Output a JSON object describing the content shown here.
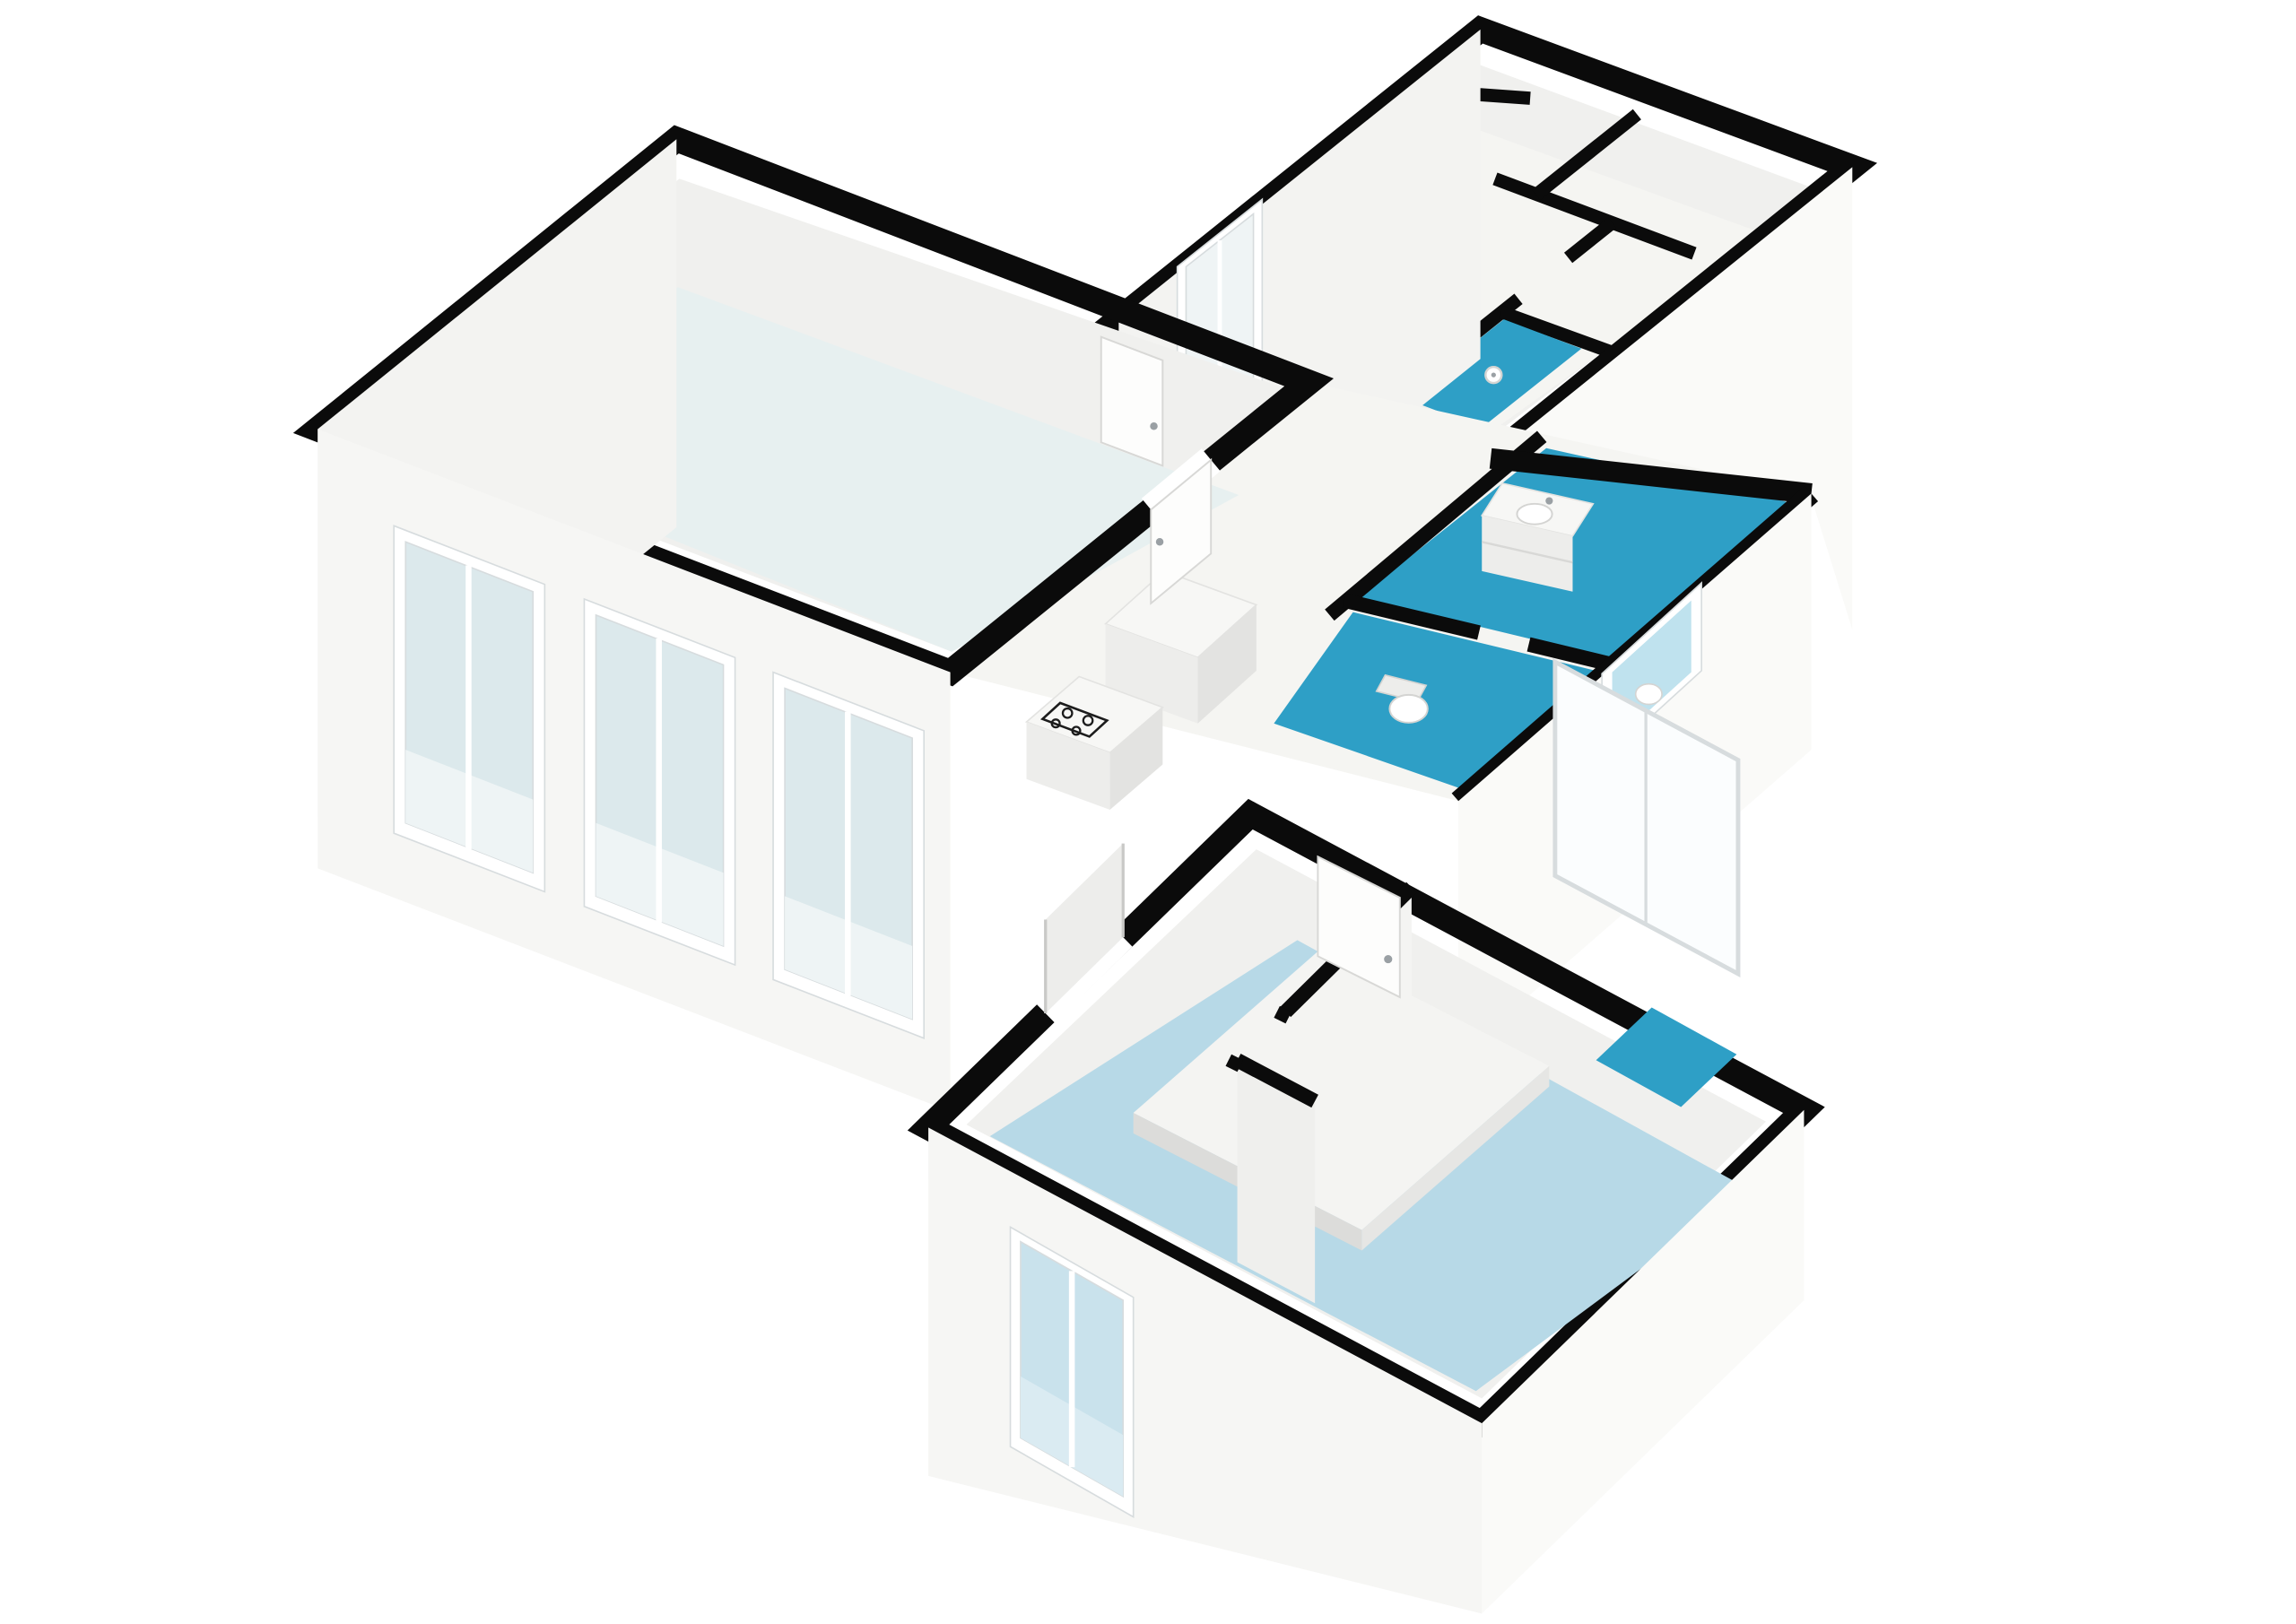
{
  "meta": {
    "type": "3d-floorplan-axonometric-render",
    "background": "#ffffff",
    "has_text": false
  },
  "colors": {
    "bg": "#ffffff",
    "wall": "#0b0b0b",
    "interior_face": "#f0f0ee",
    "floor_living": "#e7f0f0",
    "floor_hall": "#f5f5f2",
    "floor_bedroom": "#b7d9e7",
    "floor_bath": "#2e9fc6",
    "face_nw": "#f3f3f1",
    "face_sw": "#f6f6f4",
    "face_se": "#fafaf8",
    "frame": "#ffffff",
    "frame_stroke": "#d7dcde",
    "glass": "#dce9ec",
    "glass_sill": "#eef4f5",
    "glass_small": "#eff4f5",
    "glass_toilet": "#bfe2ee",
    "glass_bright": "#fbfdfe",
    "glass_bedroom": "#c9e2ec",
    "glass_bedroom_sill": "#daebf2",
    "fixture_top": "#f7f7f5",
    "fixture_stroke": "#e3e3e1",
    "fixture_side": "#ededeb",
    "fixture_side_dark": "#e3e3e1",
    "door_leaf": "#fdfdfc",
    "door_stroke": "#d8d8d6",
    "handle": "#9aa0a4",
    "hob": "#1c1c1c",
    "bed_top": "#f4f4f2",
    "bed_side": "#dcdcda",
    "bed_side_dark": "#e6e6e4",
    "part_face": "#f4f4f2",
    "part_face_dark": "#efefed",
    "pocket_panel": "#ededeb",
    "pocket_jamb": "#c9c9c7",
    "sanitary": "#ffffff",
    "sanitary_stroke": "#d4d4d2"
  },
  "rooms": [
    {
      "id": "living-kitchen",
      "name": "living room with open kitchen",
      "floor": "#e7f0f0"
    },
    {
      "id": "upper-hall",
      "name": "entrance hall with closets",
      "floor": "#f5f5f2"
    },
    {
      "id": "shower-room",
      "name": "shower room",
      "floor": "#2e9fc6"
    },
    {
      "id": "bathroom",
      "name": "bathroom with vanity",
      "floor": "#2e9fc6"
    },
    {
      "id": "toilet-room",
      "name": "toilet room",
      "floor": "#2e9fc6"
    },
    {
      "id": "bedroom",
      "name": "bedroom",
      "floor": "#b7d9e7"
    },
    {
      "id": "second-room",
      "name": "second room",
      "floor": "#b7d9e7"
    }
  ],
  "fixtures": [
    {
      "id": "kitchen-island",
      "name": "kitchen island with gas hob"
    },
    {
      "id": "tall-cabinet",
      "name": "tall kitchen cabinet"
    },
    {
      "id": "vanity-sink",
      "name": "bathroom vanity with basin and faucet"
    },
    {
      "id": "toilet",
      "name": "toilet"
    },
    {
      "id": "shower-head",
      "name": "shower head"
    },
    {
      "id": "bed",
      "name": "bed platform"
    },
    {
      "id": "doors",
      "name": "white interior door leaves with chrome handles"
    },
    {
      "id": "windows",
      "name": "white-framed windows and sliding glass doors"
    }
  ]
}
